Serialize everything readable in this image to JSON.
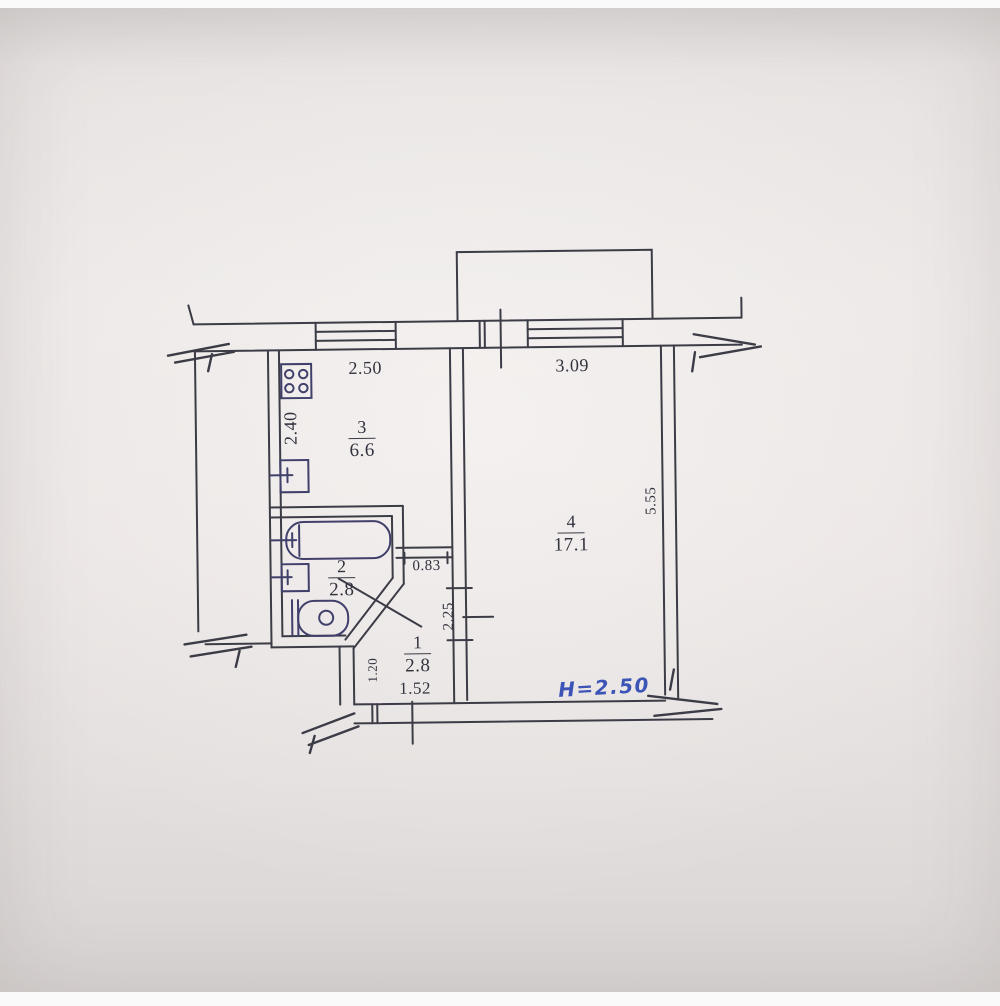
{
  "document": {
    "kind": "apartment floor plan (technical drawing photo)",
    "ceiling_height_label": "H=2.50"
  },
  "colors": {
    "paper": "#e8e4e2",
    "ink": "#3c3c46",
    "fixture_ink": "#40406b",
    "handwriting_ink": "#3b54b6"
  },
  "rooms": [
    {
      "number": "1",
      "area": "2.8"
    },
    {
      "number": "2",
      "area": "2.8"
    },
    {
      "number": "3",
      "area": "6.6"
    },
    {
      "number": "4",
      "area": "17.1"
    }
  ],
  "dimensions": {
    "kitchen_width": "2.50",
    "kitchen_depth": "2.40",
    "living_width": "3.09",
    "living_depth": "5.55",
    "kitchen_doorway": "0.83",
    "hall_depth": "2.25",
    "hall_nook_depth": "1.20",
    "hall_width": "1.52"
  }
}
